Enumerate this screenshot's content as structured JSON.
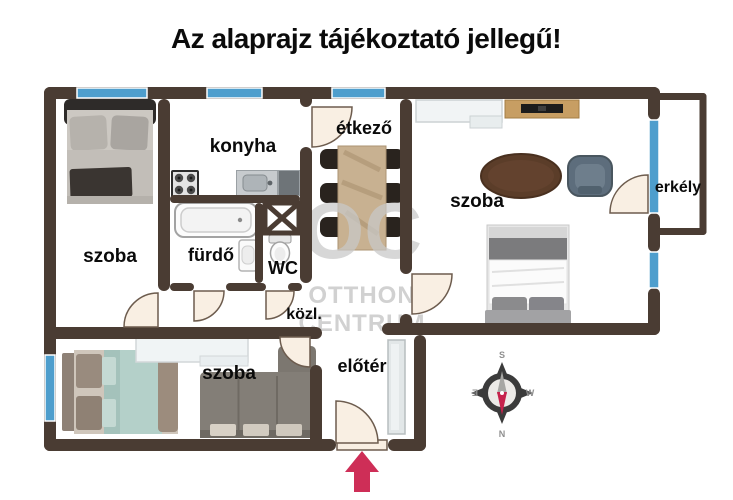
{
  "title": "Az alaprajz tájékoztató jellegű!",
  "rooms": {
    "bedroom1": "szoba",
    "kitchen": "konyha",
    "dining": "étkező",
    "living_room": "szoba",
    "balcony": "erkély",
    "bathroom": "fürdő",
    "wc": "WC",
    "hallway": "közl.",
    "bedroom2": "szoba",
    "foyer": "előtér"
  },
  "watermark": {
    "logo": "OC",
    "line1": "OTTHON",
    "line2": "CENTRUM"
  },
  "compass": {
    "top": "S",
    "bottom": "N",
    "left": "E",
    "right": "W"
  },
  "colors": {
    "wall": "#4a3c33",
    "window": "#4e9ecd",
    "door_fill": "#f9efe3",
    "entrance_arrow": "#ce2e57",
    "watermark": "#c9c9c9"
  }
}
